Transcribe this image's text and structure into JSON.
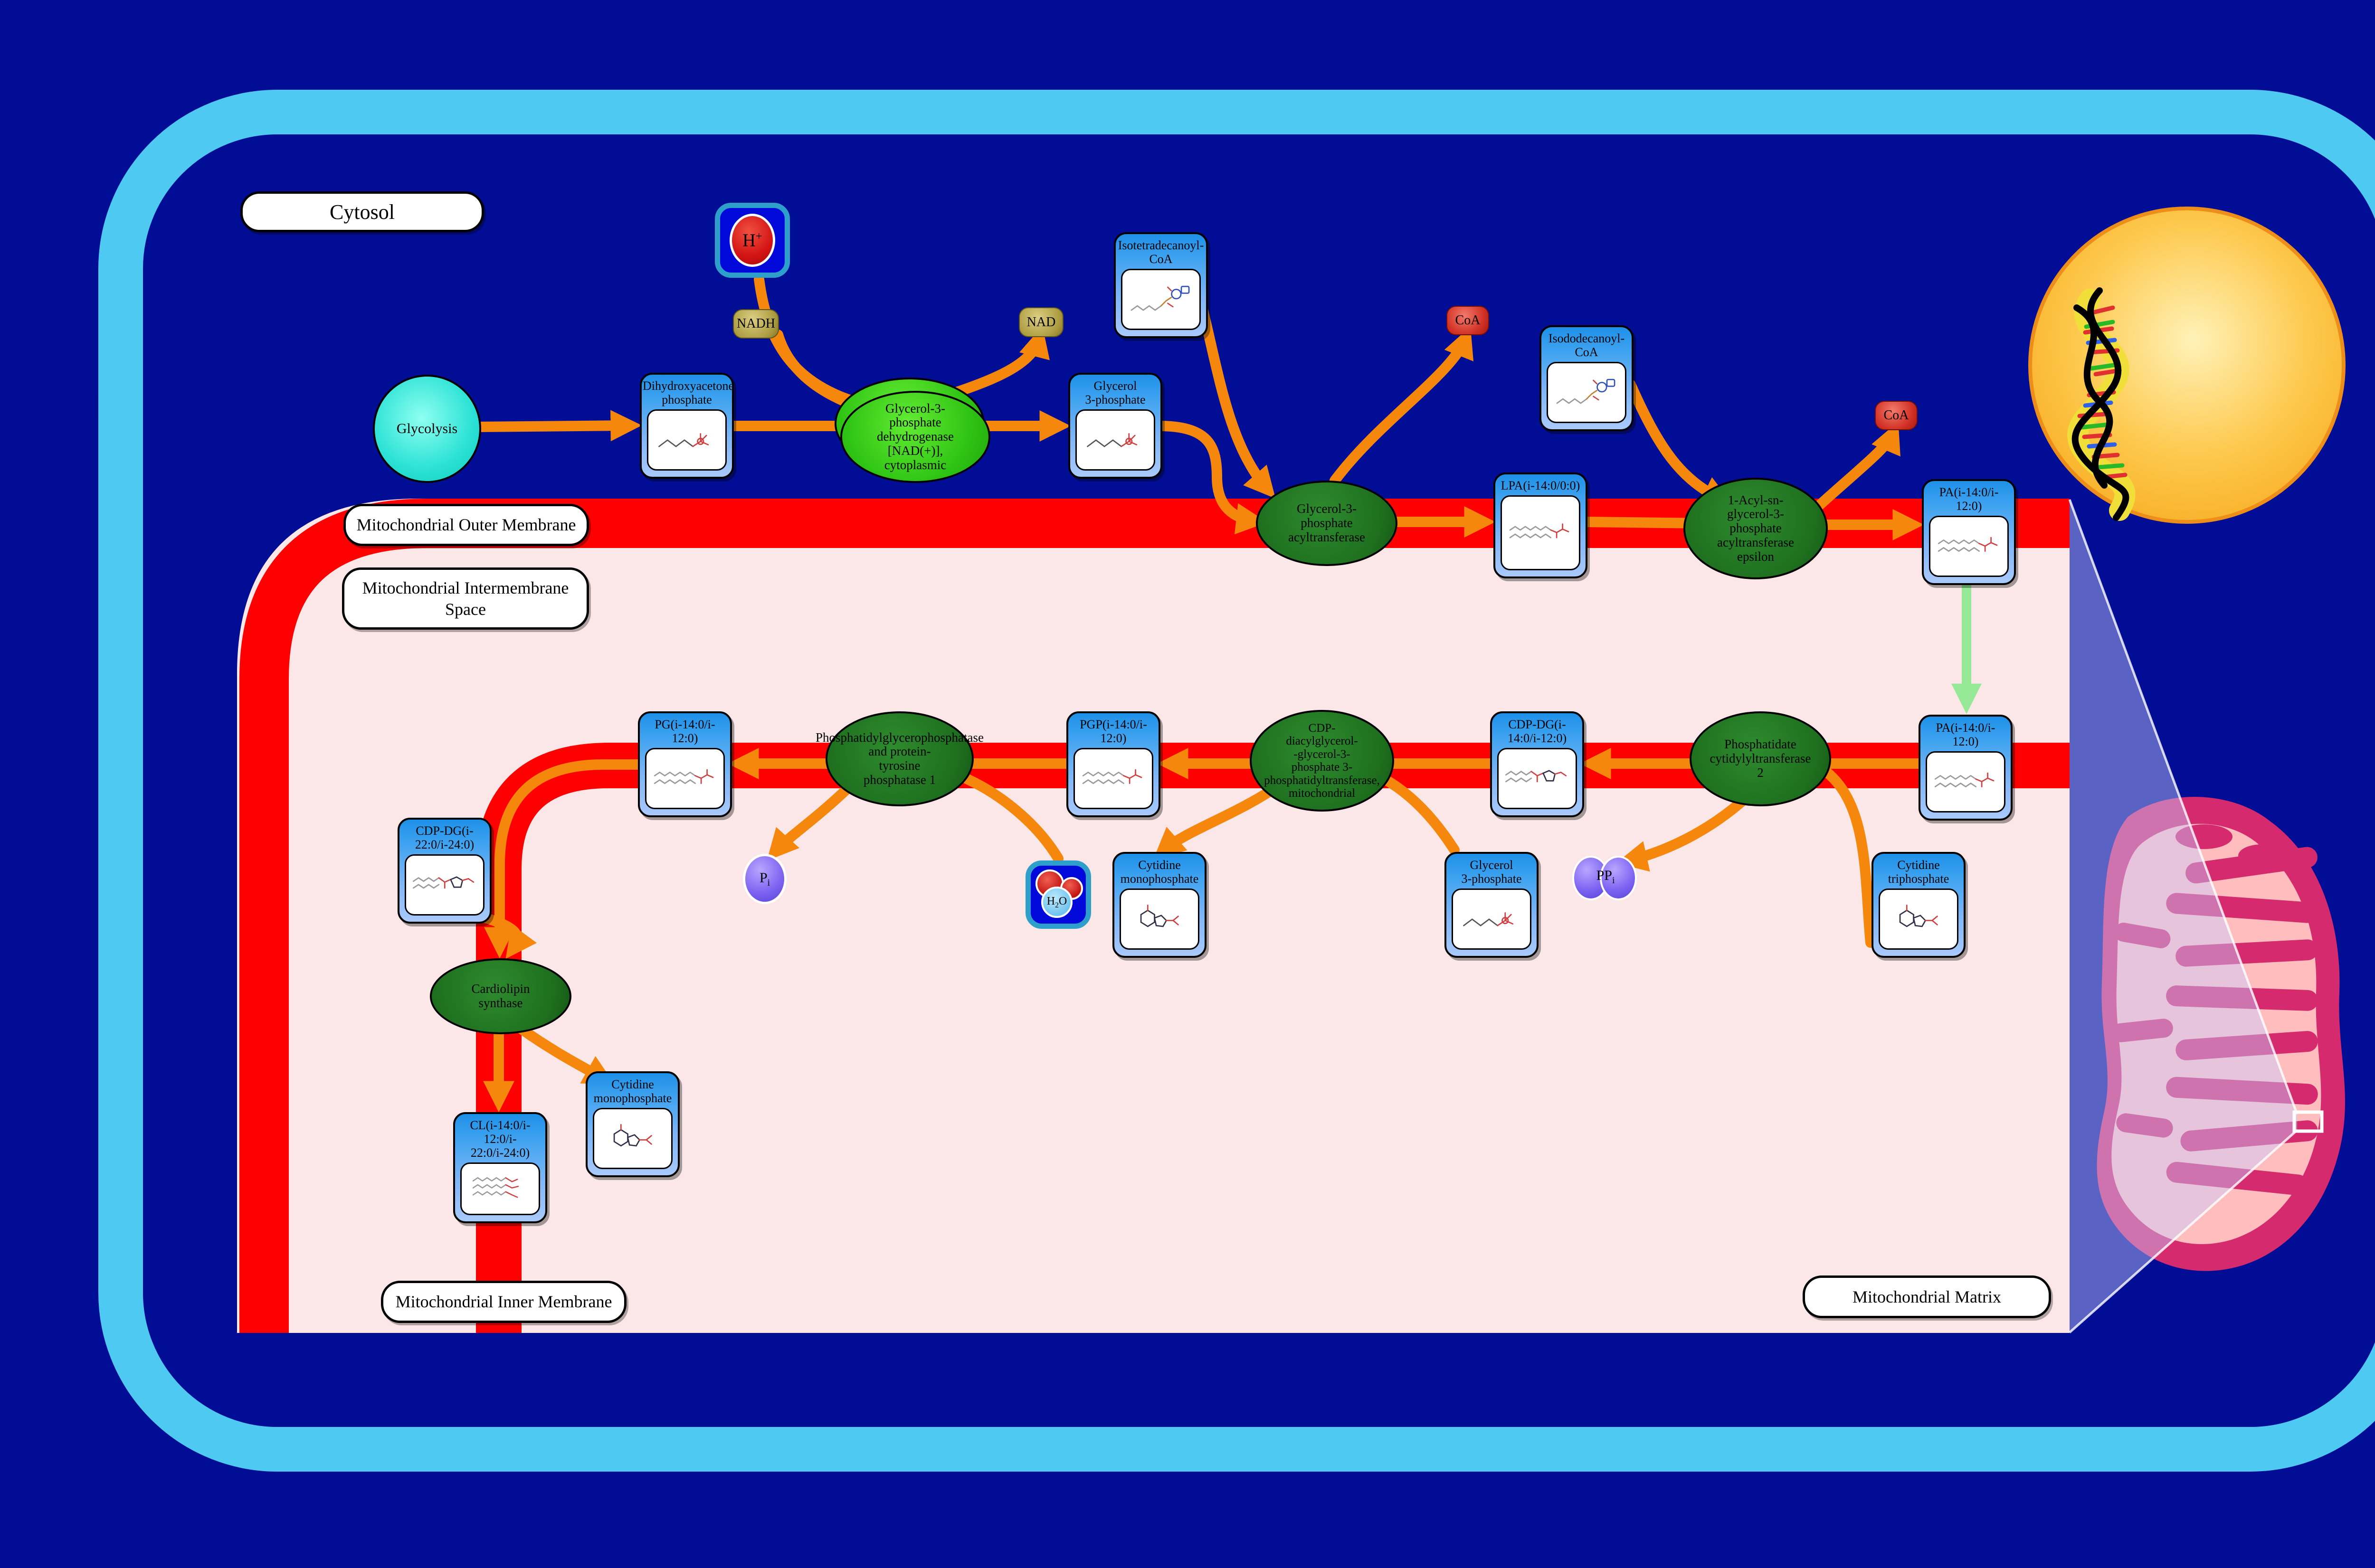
{
  "colors": {
    "background": "#000D94",
    "cell_border": "#4EC9F1",
    "membrane_red": "#FF0000",
    "compartment_pink": "#FBE7E8",
    "arrow_orange": "#F5870C",
    "arrow_green": "#95E895",
    "node_blue": "#2196F3",
    "enzyme_green_dark": "#1E6F1E",
    "enzyme_green_bright": "#2FC414",
    "nucleus_gold": "#F6A81C",
    "mitochondrion_crimson": "#D62A6E"
  },
  "labels": {
    "cytosol": "Cytosol",
    "outer_membrane": "Mitochondrial Outer Membrane",
    "intermembrane_space": "Mitochondrial Intermembrane\nSpace",
    "inner_membrane": "Mitochondrial Inner Membrane",
    "matrix": "Mitochondrial Matrix"
  },
  "source": {
    "glycolysis": "Glycolysis"
  },
  "metabolites": {
    "dhap": {
      "title": "Dihydroxyacetone\nphosphate",
      "structure": "glycerol-phosphate-skeletal"
    },
    "g3p_cytosol": {
      "title": "Glycerol\n3-phosphate",
      "structure": "glycerol-phosphate-skeletal"
    },
    "iso_c14_coa": {
      "title": "Isotetradecanoyl-\nCoA",
      "structure": "acyl-coa-skeletal"
    },
    "lpa": {
      "title": "LPA(i-14:0/0:0)",
      "structure": "lipid-chain-skeletal"
    },
    "iso_c12_coa": {
      "title": "Isododecanoyl-\nCoA",
      "structure": "acyl-coa-skeletal"
    },
    "pa_outer": {
      "title": "PA(i-14:0/i-\n12:0)",
      "structure": "lipid-chain-skeletal"
    },
    "pa_inner": {
      "title": "PA(i-14:0/i-\n12:0)",
      "structure": "lipid-chain-skeletal"
    },
    "ctp": {
      "title": "Cytidine\ntriphosphate",
      "structure": "nucleotide-skeletal"
    },
    "cdp_dg_14_12": {
      "title": "CDP-DG(i-\n14:0/i-12:0)",
      "structure": "cdp-lipid-skeletal"
    },
    "g3p_matrix": {
      "title": "Glycerol\n3-phosphate",
      "structure": "glycerol-phosphate-skeletal"
    },
    "pgp": {
      "title": "PGP(i-14:0/i-\n12:0)",
      "structure": "lipid-chain-skeletal"
    },
    "cmp_matrix": {
      "title": "Cytidine\nmonophosphate",
      "structure": "nucleotide-skeletal"
    },
    "pg": {
      "title": "PG(i-14:0/i-\n12:0)",
      "structure": "lipid-chain-skeletal"
    },
    "cdp_dg_22_24": {
      "title": "CDP-DG(i-\n22:0/i-24:0)",
      "structure": "cdp-lipid-skeletal"
    },
    "cl": {
      "title": "CL(i-14:0/i-\n12:0/i-\n22:0/i-24:0)",
      "structure": "cardiolipin-skeletal"
    },
    "cmp_inner": {
      "title": "Cytidine\nmonophosphate",
      "structure": "nucleotide-skeletal"
    }
  },
  "enzymes": {
    "gpd1": "Glycerol-3-\nphosphate\ndehydrogenase\n[NAD(+)],\ncytoplasmic",
    "gpat": "Glycerol-3-\nphosphate\nacyltransferase",
    "agpat": "1-Acyl-sn-\nglycerol-3-\nphosphate\nacyltransferase\nepsilon",
    "pcyt2": "Phosphatidate\ncytidylyltransferase\n2",
    "pgs1": "CDP-\ndiacylglycerol-\n-glycerol-3-\nphosphate 3-\nphosphatidyltransferase,\nmitochondrial",
    "ptpmt1": "Phosphatidylglycerophosphatase\nand protein-\ntyrosine\nphosphatase 1",
    "cls": "Cardiolipin\nsynthase"
  },
  "cofactors": {
    "h_plus": {
      "base": "H",
      "sup": "+"
    },
    "nadh": {
      "label": "NADH"
    },
    "nad": {
      "label": "NAD"
    },
    "coa_top": {
      "label": "CoA"
    },
    "coa_right": {
      "label": "CoA"
    },
    "pi": {
      "base": "P",
      "sub": "i"
    },
    "ppi": {
      "base": "PP",
      "sub": "i"
    },
    "h2o": {
      "base": "H",
      "sub": "2",
      "rest": "O"
    }
  }
}
